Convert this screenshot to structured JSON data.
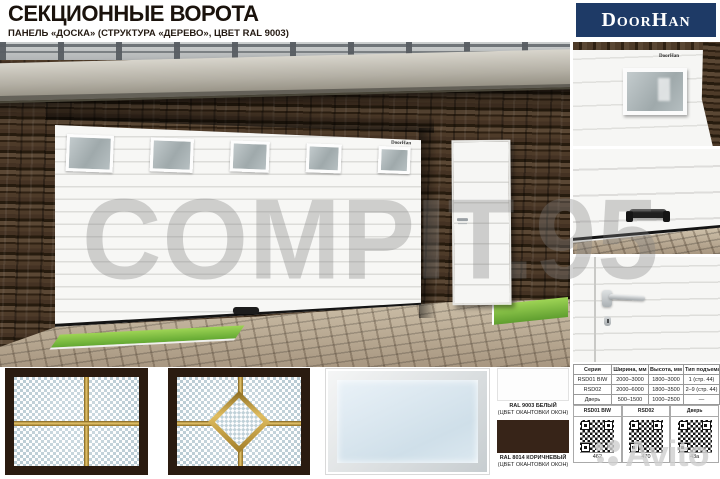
{
  "header": {
    "title": "СЕКЦИОННЫЕ ВОРОТА",
    "subtitle": "ПАНЕЛЬ «ДОСКА» (СТРУКТУРА «ДЕРЕВО», ЦВЕТ RAL 9003)",
    "brand": "DoorHan",
    "brand_bg": "#1e3a66"
  },
  "photo": {
    "door_logo": "DoorHan"
  },
  "details": {
    "window_logo": "DoorHan"
  },
  "swatches": [
    {
      "name": "RAL 9003 БЕЛЫЙ",
      "note": "(ЦВЕТ ОКАНТОВКИ ОКОН)",
      "color": "#fdfdfd"
    },
    {
      "name": "RAL 8014 КОРИЧНЕВЫЙ",
      "note": "(ЦВЕТ ОКАНТОВКИ ОКОН)",
      "color": "#372418"
    }
  ],
  "spec_table": {
    "headers": [
      "Серия",
      "Ширина, мм",
      "Высота, мм",
      "Тип подъема"
    ],
    "rows": [
      [
        "RSD01 BIW",
        "2000–3000",
        "1800–3000",
        "1 (стр. 44)"
      ],
      [
        "RSD02",
        "2000–6000",
        "1800–3500",
        "2–9 (стр. 44)"
      ],
      [
        "Дверь",
        "500–1500",
        "1000–2500",
        "—"
      ]
    ]
  },
  "qr_section": {
    "items": [
      {
        "label": "RSD01 BIW",
        "code": "462"
      },
      {
        "label": "RSD02",
        "code": "470"
      },
      {
        "label": "Дверь",
        "code": "43a"
      }
    ]
  },
  "watermarks": {
    "center": "COMPIT.95",
    "corner": "Avito"
  },
  "accent_colors": {
    "gold_trim": "#e0bd60",
    "thumb_frame_brown": "#2a1b10",
    "stone_wall": "#3b2c1f"
  }
}
